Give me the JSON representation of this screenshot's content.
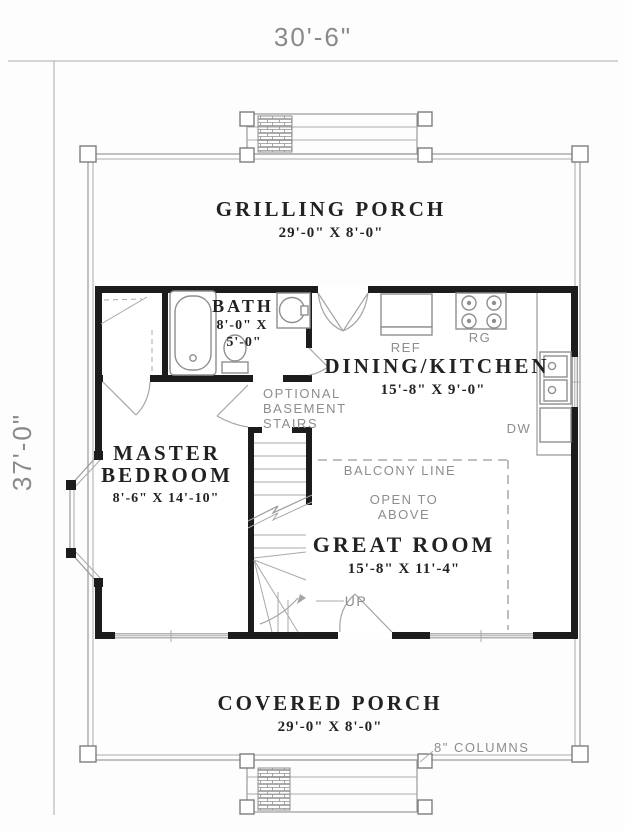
{
  "plan": {
    "overall_width": "30'-6\"",
    "overall_depth": "37'-0\"",
    "rooms": {
      "grilling_porch": {
        "name": "GRILLING PORCH",
        "dims": "29'-0\" X 8'-0\""
      },
      "covered_porch": {
        "name": "COVERED PORCH",
        "dims": "29'-0\" X 8'-0\""
      },
      "bath": {
        "name": "BATH",
        "dims1": "8'-0\" X",
        "dims2": "5'-0\""
      },
      "dining_kitchen": {
        "name": "DINING/KITCHEN",
        "dims": "15'-8\" X 9'-0\""
      },
      "master_bedroom": {
        "name1": "MASTER",
        "name2": "BEDROOM",
        "dims": "8'-6\" X 14'-10\""
      },
      "great_room": {
        "name": "GREAT ROOM",
        "dims": "15'-8\" X 11'-4\""
      }
    },
    "labels": {
      "ref": "REF",
      "rg": "RG",
      "dw": "DW",
      "up": "UP",
      "optional1": "OPTIONAL",
      "optional2": "BASEMENT",
      "optional3": "STAIRS",
      "balcony": "BALCONY LINE",
      "open1": "OPEN TO",
      "open2": "ABOVE",
      "columns": "8\" COLUMNS"
    },
    "colors": {
      "wall": "#1c1c1c",
      "thin_line": "#999999",
      "room_text": "#222222",
      "muted_text": "#8d8d8d",
      "background": "#ffffff"
    }
  }
}
